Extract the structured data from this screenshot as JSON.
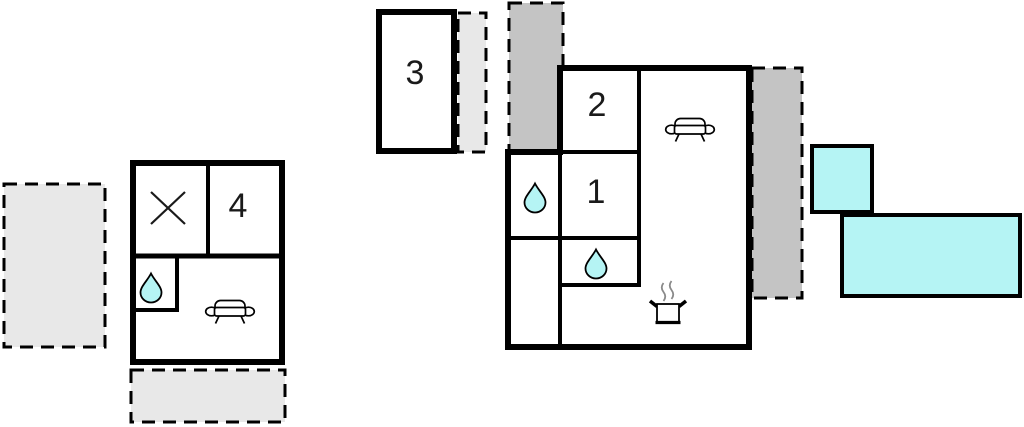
{
  "plan": {
    "rooms": {
      "room1": {
        "label": "1"
      },
      "room2": {
        "label": "2"
      },
      "room3": {
        "label": "3"
      },
      "room4": {
        "label": "4"
      }
    },
    "icons": {
      "cross": "cross-icon",
      "water_drop": "water-drop-icon",
      "sofa": "sofa-icon",
      "cooking_pot": "cooking-pot-icon"
    },
    "colors": {
      "wall": "#000000",
      "area_light_gray": "#e8e8e8",
      "area_dark_gray": "#c4c4c4",
      "water_cyan": "#b5f4f4",
      "steam_gray": "#8a8a8a",
      "background": "#ffffff"
    }
  }
}
